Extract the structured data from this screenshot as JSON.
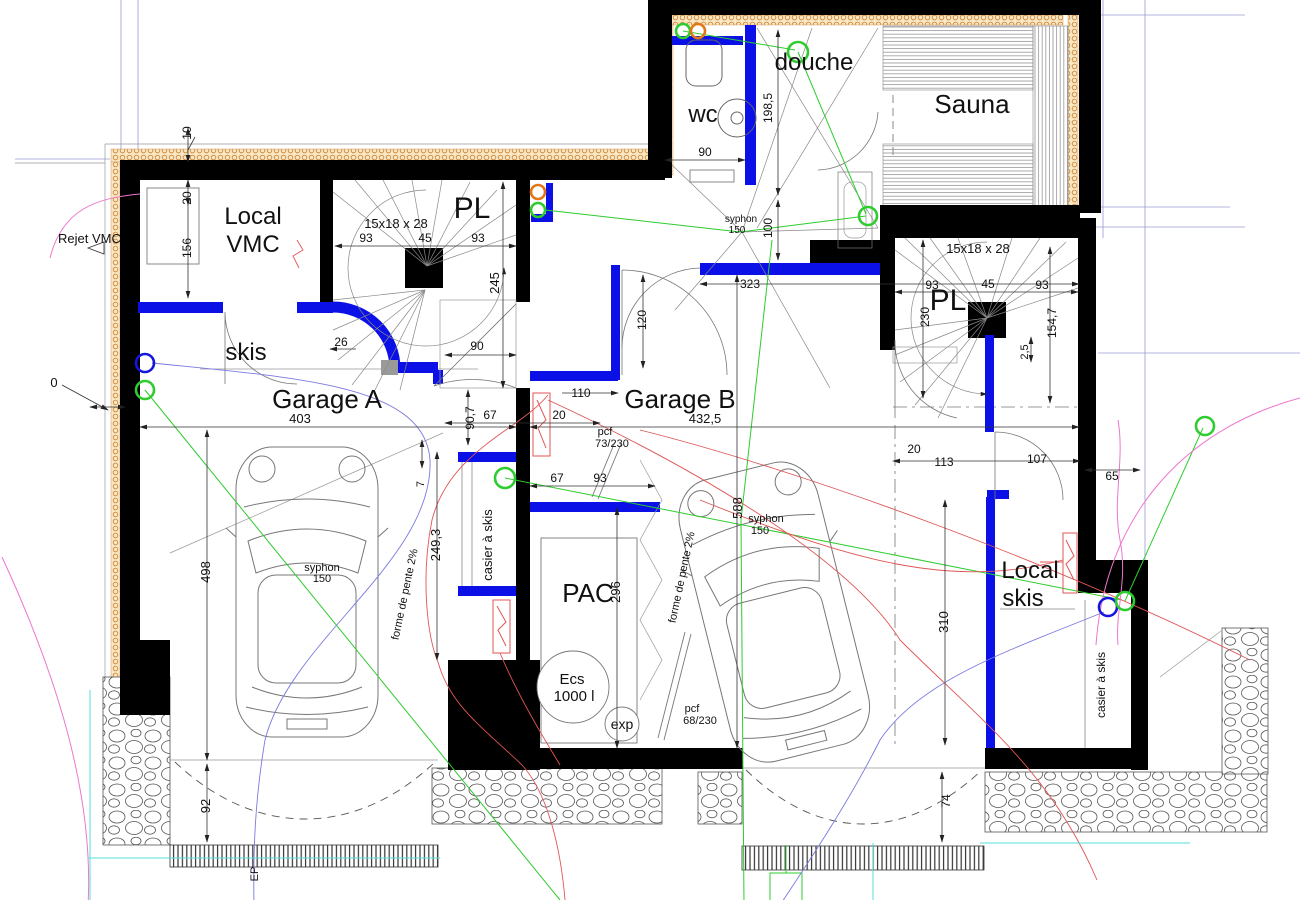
{
  "drawing": {
    "rooms": {
      "local_vmc_l1": "Local",
      "local_vmc_l2": "VMC",
      "skis": "skis",
      "garage_a": "Garage A",
      "garage_b": "Garage B",
      "pac": "PAC",
      "pl_left": "PL",
      "pl_right": "PL",
      "wc": "wc",
      "douche": "douche",
      "sauna": "Sauna",
      "local_skis_l1": "Local",
      "local_skis_l2": "skis"
    },
    "annotations": {
      "stair_spec": "15x18 x 28",
      "rejet_vmc": "Rejet VMC",
      "syphon": "syphon",
      "syphon_150": "150",
      "casier_a_skis": "casier à skis",
      "forme_de_pente": "forme de pente 2%",
      "pcf": "pcf",
      "pcf_73_230": "73/230",
      "pcf_68_230": "68/230",
      "ecs_l1": "Ecs",
      "ecs_l2": "1000 l",
      "exp": "exp",
      "ep": "EP"
    },
    "dimensions": {
      "d0": "0",
      "d10": "10",
      "d20": "20",
      "d156": "156",
      "d93": "93",
      "d45": "45",
      "d245": "245",
      "d90": "90",
      "d26": "26",
      "d110": "110",
      "d90_7": "90,7",
      "d67": "67",
      "d403": "403",
      "d432_5": "432,5",
      "d323": "323",
      "d120": "120",
      "d249_3": "249,3",
      "d7": "7",
      "d296": "296",
      "d498": "498",
      "d92": "92",
      "d588": "588",
      "d198_5": "198,5",
      "d100": "100",
      "d230": "230",
      "d154_7": "154,7",
      "d2_5": "2,5",
      "d113": "113",
      "d107": "107",
      "d65": "65",
      "d310": "310",
      "d74": "74"
    },
    "colors": {
      "wall": "#000000",
      "reinforced_wall_blue": "#0a10e6",
      "insulation_orange": "#cf8a3e",
      "electric_green": "#2ecc2e",
      "plumbing_red": "#e05555",
      "water_blue": "#7a7ae0",
      "vmc_pink": "#ee77cc",
      "cyan_line": "#55dddd"
    }
  }
}
